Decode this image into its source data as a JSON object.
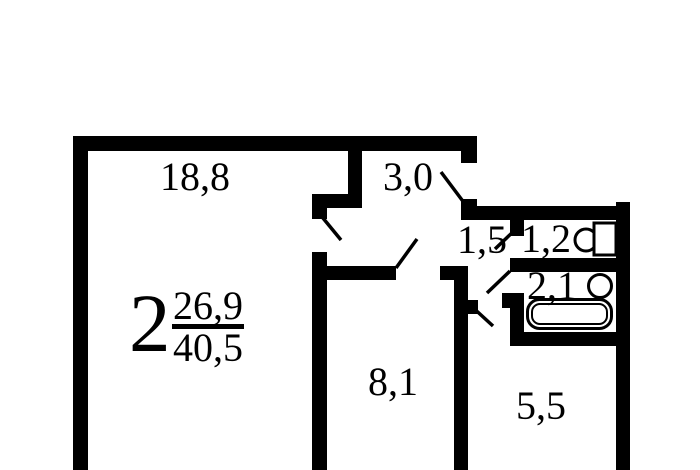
{
  "apartment": {
    "rooms_count": "2",
    "living_area": "26,9",
    "total_area": "40,5"
  },
  "rooms": {
    "living_room": "18,8",
    "hallway": "3,0",
    "corridor": "1,5",
    "wc": "1,2",
    "bathroom": "2,1",
    "second_room": "8,1",
    "kitchen": "5,5"
  },
  "fixtures": {
    "toilet": "toilet-icon",
    "sink": "sink-icon",
    "bathtub": "bathtub-icon"
  },
  "colors": {
    "wall": "#000000",
    "background": "#ffffff"
  }
}
